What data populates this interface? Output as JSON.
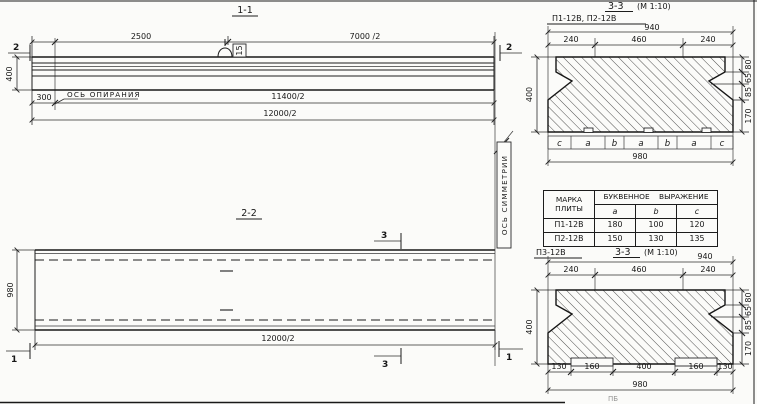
{
  "colors": {
    "ink": "#1c1c1c",
    "paper": "#fbfbf9"
  },
  "section_1_1": {
    "title": "1-1",
    "dim_top_left": "2500",
    "dim_top_right": "7000 /2",
    "dim_400": "400",
    "dim_300": "300",
    "dim_11400": "11400/2",
    "dim_12000": "12000/2",
    "bearing_axis_label": "ОСЬ ОПИРАНИЯ",
    "loop_tag": "15",
    "cut_left": "2",
    "cut_right": "2"
  },
  "section_2_2": {
    "title": "2-2",
    "dim_980": "980",
    "dim_12000": "12000/2",
    "symmetry_axis_label": "ОСЬ СИММЕТРИИ",
    "cut_top": "3",
    "cut_bottom": "3",
    "cut_left": "1",
    "cut_right": "1"
  },
  "section_p12": {
    "label": "П1-12В, П2-12В",
    "title": "3-3",
    "scale": "(М 1:10)",
    "dim_940": "940",
    "top_dims": [
      "240",
      "460",
      "240"
    ],
    "dim_400": "400",
    "right_dims": [
      "80",
      "65",
      "85",
      "170"
    ],
    "letters": [
      "c",
      "a",
      "b",
      "a",
      "b",
      "a",
      "c"
    ],
    "dim_980": "980"
  },
  "table": {
    "header_mark": "МАРКА ПЛИТЫ",
    "header_expression": "БУКВЕННОЕ ВЫРАЖЕНИЕ",
    "cols": [
      "a",
      "b",
      "c"
    ],
    "rows": [
      {
        "mark": "П1-12В",
        "a": "180",
        "b": "100",
        "c": "120"
      },
      {
        "mark": "П2-12В",
        "a": "150",
        "b": "130",
        "c": "135"
      }
    ]
  },
  "section_p3": {
    "label": "П3-12В",
    "title": "3-3",
    "scale": "(М 1:10)",
    "dim_940": "940",
    "top_dims": [
      "240",
      "460",
      "240"
    ],
    "dim_400": "400",
    "right_dims": [
      "80",
      "65",
      "85",
      "170"
    ],
    "bottom_dims": [
      "130",
      "160",
      "400",
      "160",
      "130"
    ],
    "dim_980": "980"
  },
  "artifact_text": "ПБ"
}
